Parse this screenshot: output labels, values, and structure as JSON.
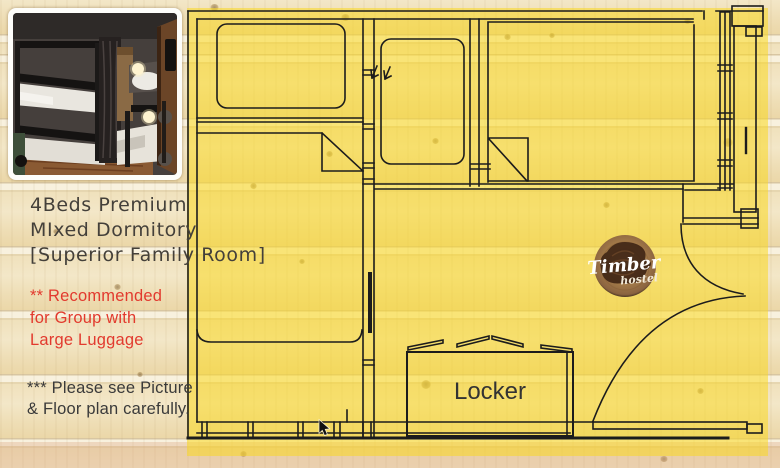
{
  "listing": {
    "title_lines": [
      "4Beds Premium",
      "MIxed Dormitory",
      "[Superior Family Room]"
    ],
    "recommend_lines": [
      "** Recommended",
      "for Group with",
      "Large Luggage"
    ],
    "note_lines": [
      "*** Please see Picture",
      "& Floor plan carefully."
    ]
  },
  "floorplan": {
    "locker_label": "Locker",
    "logo": {
      "name": "Timber",
      "subtitle": "hostel"
    }
  },
  "colors": {
    "highlight_yellow": "#f7d831",
    "red_text": "#e23a2e",
    "title_text": "#44403a",
    "note_text": "#3a3a3a",
    "plan_line": "#1c1c1c",
    "wood_base": "#efe0ba",
    "logo_wood": "#a57c49"
  }
}
